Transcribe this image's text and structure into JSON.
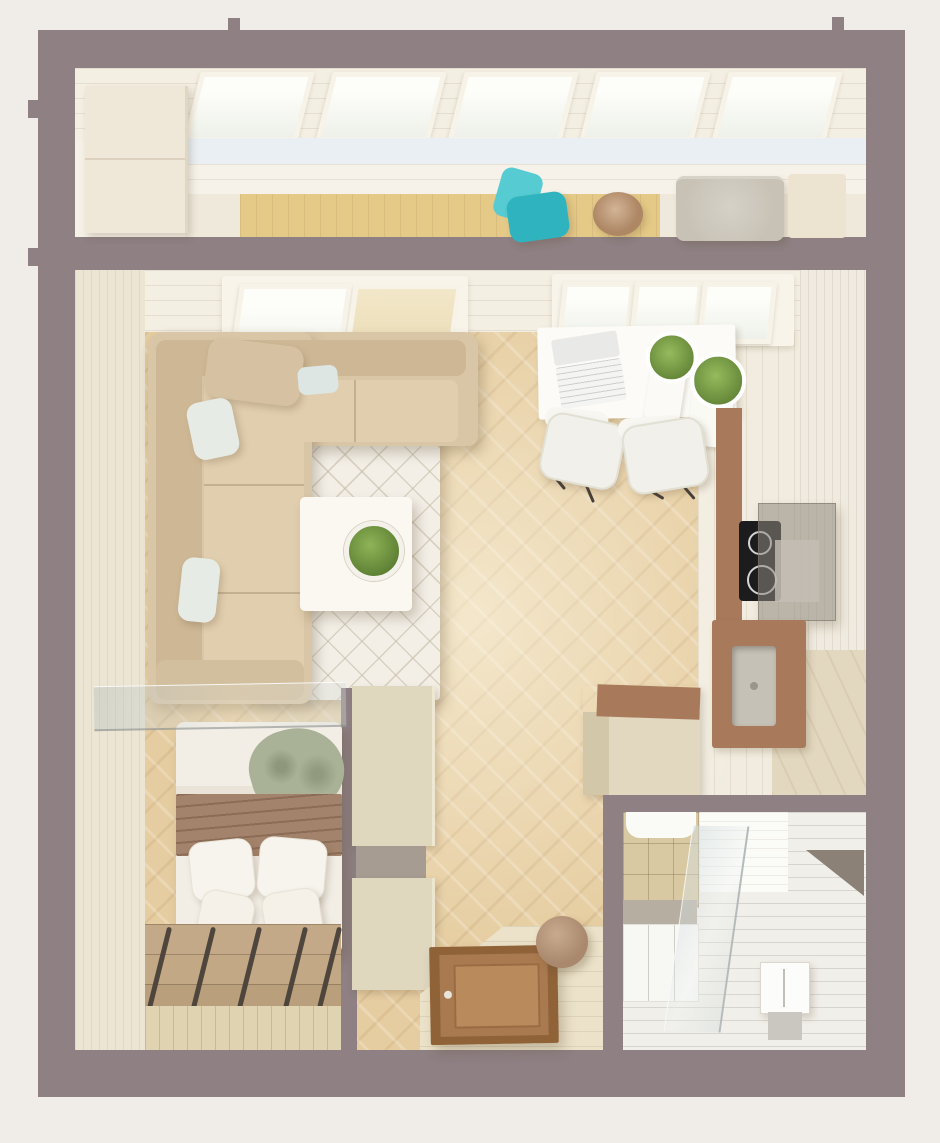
{
  "scene": {
    "type": "3d-floor-plan-top-view",
    "description": "Top-down 3D render of a small studio apartment with balcony, living area, work corner, kitchen, bedroom nook, hallway and bathroom",
    "rooms": [
      {
        "id": "balcony",
        "label": "Balcony",
        "furniture": [
          "storage-cabinet",
          "skylight-windows",
          "teal-lounge-chair",
          "round-side-table",
          "storage-ottoman",
          "cream-box"
        ]
      },
      {
        "id": "living-room",
        "label": "Living room",
        "furniture": [
          "corner-sofa",
          "back-pillow",
          "white-pillows",
          "quilted-rug",
          "coffee-table",
          "potted-plant"
        ]
      },
      {
        "id": "work-area",
        "label": "Work area",
        "furniture": [
          "desk",
          "laptop",
          "two-potted-plants",
          "two-chairs"
        ]
      },
      {
        "id": "kitchen",
        "label": "Kitchen",
        "furniture": [
          "induction-cooktop",
          "range-hood",
          "steel-sink",
          "wood-counter",
          "peninsula-cabinet"
        ]
      },
      {
        "id": "bedroom",
        "label": "Bedroom nook",
        "furniture": [
          "double-bed",
          "brown-blanket",
          "green-throw",
          "four-pillows",
          "glass-partition",
          "bed-steps-with-rails"
        ]
      },
      {
        "id": "hallway",
        "label": "Hallway",
        "furniture": [
          "wardrobe-upper",
          "wardrobe-shelf",
          "wardrobe-lower",
          "entrance-door",
          "round-stool"
        ]
      },
      {
        "id": "bathroom",
        "label": "Bathroom",
        "furniture": [
          "vanity-sink",
          "vanity-cabinet",
          "glass-shower-screen",
          "corner-shelf",
          "shower-tray"
        ]
      }
    ],
    "palette": {
      "background": "#f0ece7",
      "wall": "#8e8083",
      "inner_wall_wood": "#ece5d4",
      "ceiling_plank": "#f4efe3",
      "floor_herringbone": "#e6cda1",
      "floor_pale": "#f1ecdf",
      "balcony_wood": "#e5c987",
      "cabinet_cream": "#efe8d8",
      "teal_chair": "#2fb4bf",
      "teal_chair_back": "#56cbd2",
      "side_table_wood": "#ae8765",
      "ottoman_gray": "#c8c2b6",
      "cream_box": "#ece4d0",
      "sofa": "#d9c6a7",
      "sofa_back": "#cdb794",
      "sofa_seat": "#e0ceae",
      "pillow_white": "#e7ebe6",
      "rug": "#f3efe7",
      "coffee_table": "#fbf8f1",
      "plant_green": "#7ca448",
      "desk_white": "#fcfbf7",
      "chair_white": "#f1f0ea",
      "counter_wood": "#a8795a",
      "counter_beige": "#e2d7bf",
      "cooktop_black": "#1c1c1e",
      "hood_gray": "#8f8a82",
      "sink_steel": "#c6c1b6",
      "bed_white": "#f2eee6",
      "blanket_brown": "#a3836b",
      "throw_green": "#a9b296",
      "steps_tan": "#c3a987",
      "rail_dark": "#4e453c",
      "wardrobe_cream": "#e0d7bf",
      "wardrobe_shelf": "#a79c92",
      "door_frame": "#8f6238",
      "door_panel": "#a97a4f",
      "stool_brown": "#a9886d",
      "bath_floor": "#f1efe9",
      "bath_tile": "#d9c9a2",
      "bath_counter": "#b6aea0",
      "shelf_dark": "#8b8177",
      "floor_entry": "#ebe2c9",
      "bed_floor_plank": "#dfd3b2"
    }
  }
}
